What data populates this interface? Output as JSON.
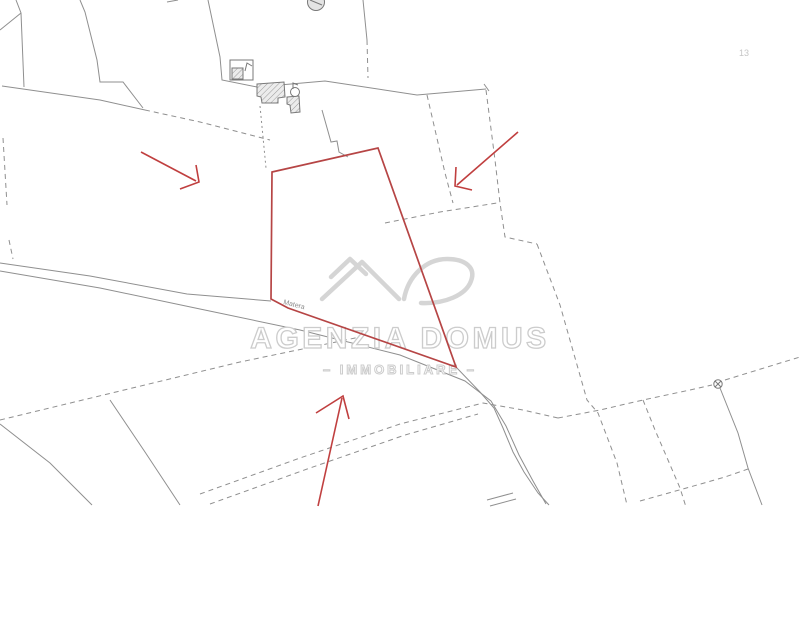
{
  "watermark": {
    "brand": "AGENZIA DOMUS",
    "tagline": "– IMMOBILIARE –"
  },
  "labels": {
    "road_name": "Matera",
    "sheet_number": "13"
  },
  "colors": {
    "parcel_outline": "#b64545",
    "arrow": "#c03f3f",
    "map_line": "#8f8f8f",
    "building_line": "#787878",
    "watermark_text": "#cccccc",
    "watermark_logo": "#d5d5d5",
    "background": "#ffffff"
  },
  "symbols": {
    "survey_marker": "circle-x-marker",
    "well": "small-circle-with-cross",
    "buildings": "hatched-polygons",
    "water_tank": "grey-filled-circle"
  },
  "annotations": {
    "highlight": "red parcel boundary polygon",
    "arrows": [
      "upper-left arrow pointing to parcel",
      "upper-right arrow pointing to parcel",
      "bottom arrow pointing to parcel"
    ]
  }
}
